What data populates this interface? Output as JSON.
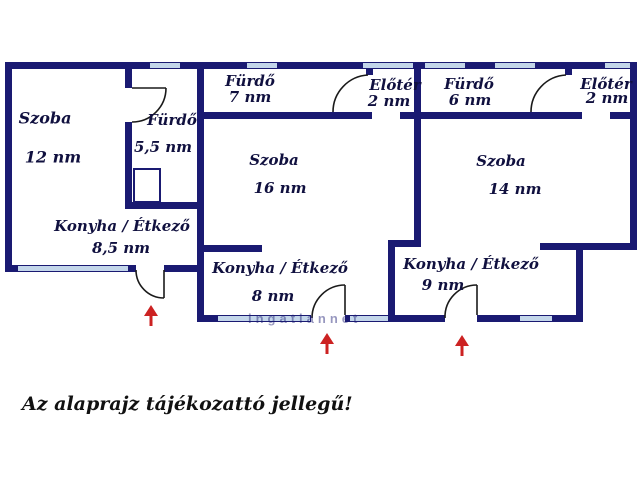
{
  "note": "Az alaprajz tájékozattó jellegű!",
  "watermark": "ingatlannet",
  "colors": {
    "wall": "#1a1a72",
    "window_glass": "#c3d6ea",
    "door_arc": "#1a1a1a",
    "arrow": "#cc2222",
    "label_text": "#10103f",
    "note_text": "#111111"
  },
  "units": [
    {
      "id": 1,
      "rooms": [
        {
          "name": "Szoba",
          "area": "12 nm"
        },
        {
          "name": "Fürdő",
          "area": "5,5 nm"
        },
        {
          "name": "Konyha / Étkező",
          "area": "8,5 nm"
        }
      ]
    },
    {
      "id": 2,
      "rooms": [
        {
          "name": "Fürdő",
          "area": "7 nm"
        },
        {
          "name": "Előtér",
          "area": "2 nm"
        },
        {
          "name": "Szoba",
          "area": "16 nm"
        },
        {
          "name": "Konyha / Étkező",
          "area": "8 nm"
        }
      ]
    },
    {
      "id": 3,
      "rooms": [
        {
          "name": "Fürdő",
          "area": "6 nm"
        },
        {
          "name": "Előtér",
          "area": "2 nm"
        },
        {
          "name": "Szoba",
          "area": "14 nm"
        },
        {
          "name": "Konyha / Étkező",
          "area": "9 nm"
        }
      ]
    }
  ]
}
